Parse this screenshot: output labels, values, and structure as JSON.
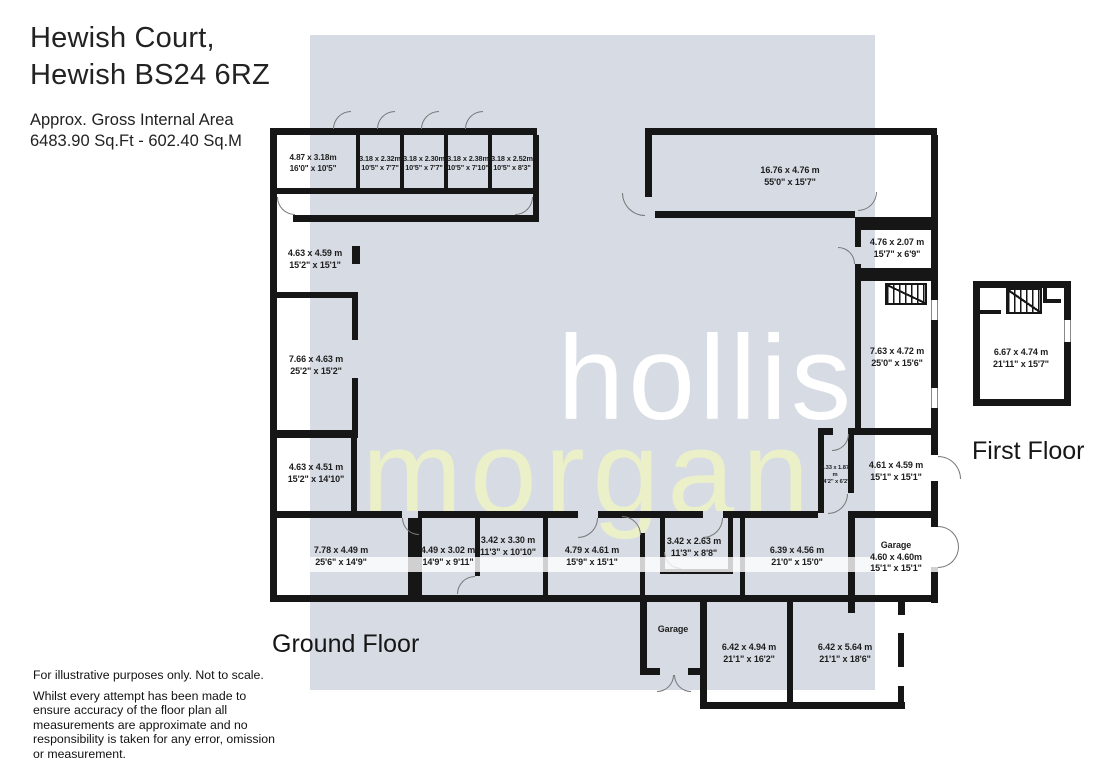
{
  "header": {
    "title_line1": "Hewish Court,",
    "title_line2": "Hewish BS24 6RZ",
    "area_line1": "Approx. Gross Internal Area",
    "area_line2": "6483.90 Sq.Ft - 602.40 Sq.M"
  },
  "watermark": {
    "word1": "hollis",
    "word2": "morgan",
    "square_color": "#d7dce4",
    "word1_color": "#ffffff",
    "word2_color": "#ebf0c9",
    "wall_color": "#161616"
  },
  "floors": {
    "ground": {
      "label": "Ground Floor",
      "rooms": [
        {
          "metric": "4.87 x 3.18m",
          "imperial": "16'0\" x 10'5\""
        },
        {
          "metric": "3.18 x 2.32m",
          "imperial": "10'5\" x 7'7\""
        },
        {
          "metric": "3.18 x 2.30m",
          "imperial": "10'5\" x 7'7\""
        },
        {
          "metric": "3.18 x 2.38m",
          "imperial": "10'5\" x 7'10\""
        },
        {
          "metric": "3.18 x 2.52m",
          "imperial": "10'5\" x 8'3\""
        },
        {
          "metric": "16.76 x 4.76 m",
          "imperial": "55'0\" x 15'7\""
        },
        {
          "metric": "4.63 x 4.59 m",
          "imperial": "15'2\" x 15'1\""
        },
        {
          "metric": "7.66 x 4.63 m",
          "imperial": "25'2\" x 15'2\""
        },
        {
          "metric": "4.63 x 4.51 m",
          "imperial": "15'2\" x 14'10\""
        },
        {
          "metric": "4.76 x 2.07 m",
          "imperial": "15'7\" x 6'9\""
        },
        {
          "metric": "7.63 x 4.72 m",
          "imperial": "25'0\" x 15'6\""
        },
        {
          "metric": "4.33 x 1.87 m",
          "imperial": "14'2\" x 6'2\""
        },
        {
          "metric": "4.61 x 4.59 m",
          "imperial": "15'1\" x 15'1\""
        },
        {
          "name": "Garage",
          "metric": "4.60 x 4.60m",
          "imperial": "15'1\" x 15'1\""
        },
        {
          "metric": "7.78 x 4.49 m",
          "imperial": "25'6\" x 14'9\""
        },
        {
          "metric": "4.49 x 3.02 m",
          "imperial": "14'9\" x 9'11\""
        },
        {
          "metric": "3.42 x 3.30 m",
          "imperial": "11'3\" x 10'10\""
        },
        {
          "metric": "4.79 x 4.61 m",
          "imperial": "15'9\" x 15'1\""
        },
        {
          "metric": "3.42 x 2.63 m",
          "imperial": "11'3\" x 8'8\""
        },
        {
          "metric": "6.39 x 4.56 m",
          "imperial": "21'0\" x 15'0\""
        },
        {
          "name": "Garage"
        },
        {
          "metric": "6.42 x 4.94 m",
          "imperial": "21'1\" x 16'2\""
        },
        {
          "metric": "6.42 x 5.64 m",
          "imperial": "21'1\" x 18'6\""
        }
      ]
    },
    "first": {
      "label": "First Floor",
      "rooms": [
        {
          "metric": "6.67 x 4.74 m",
          "imperial": "21'11\" x 15'7\""
        }
      ]
    }
  },
  "footer": {
    "line1": "For illustrative purposes only. Not to scale.",
    "line2": "Whilst every attempt has been made to ensure accuracy of the floor plan all measurements are approximate and no responsibility is taken for any error, omission or measurement."
  }
}
